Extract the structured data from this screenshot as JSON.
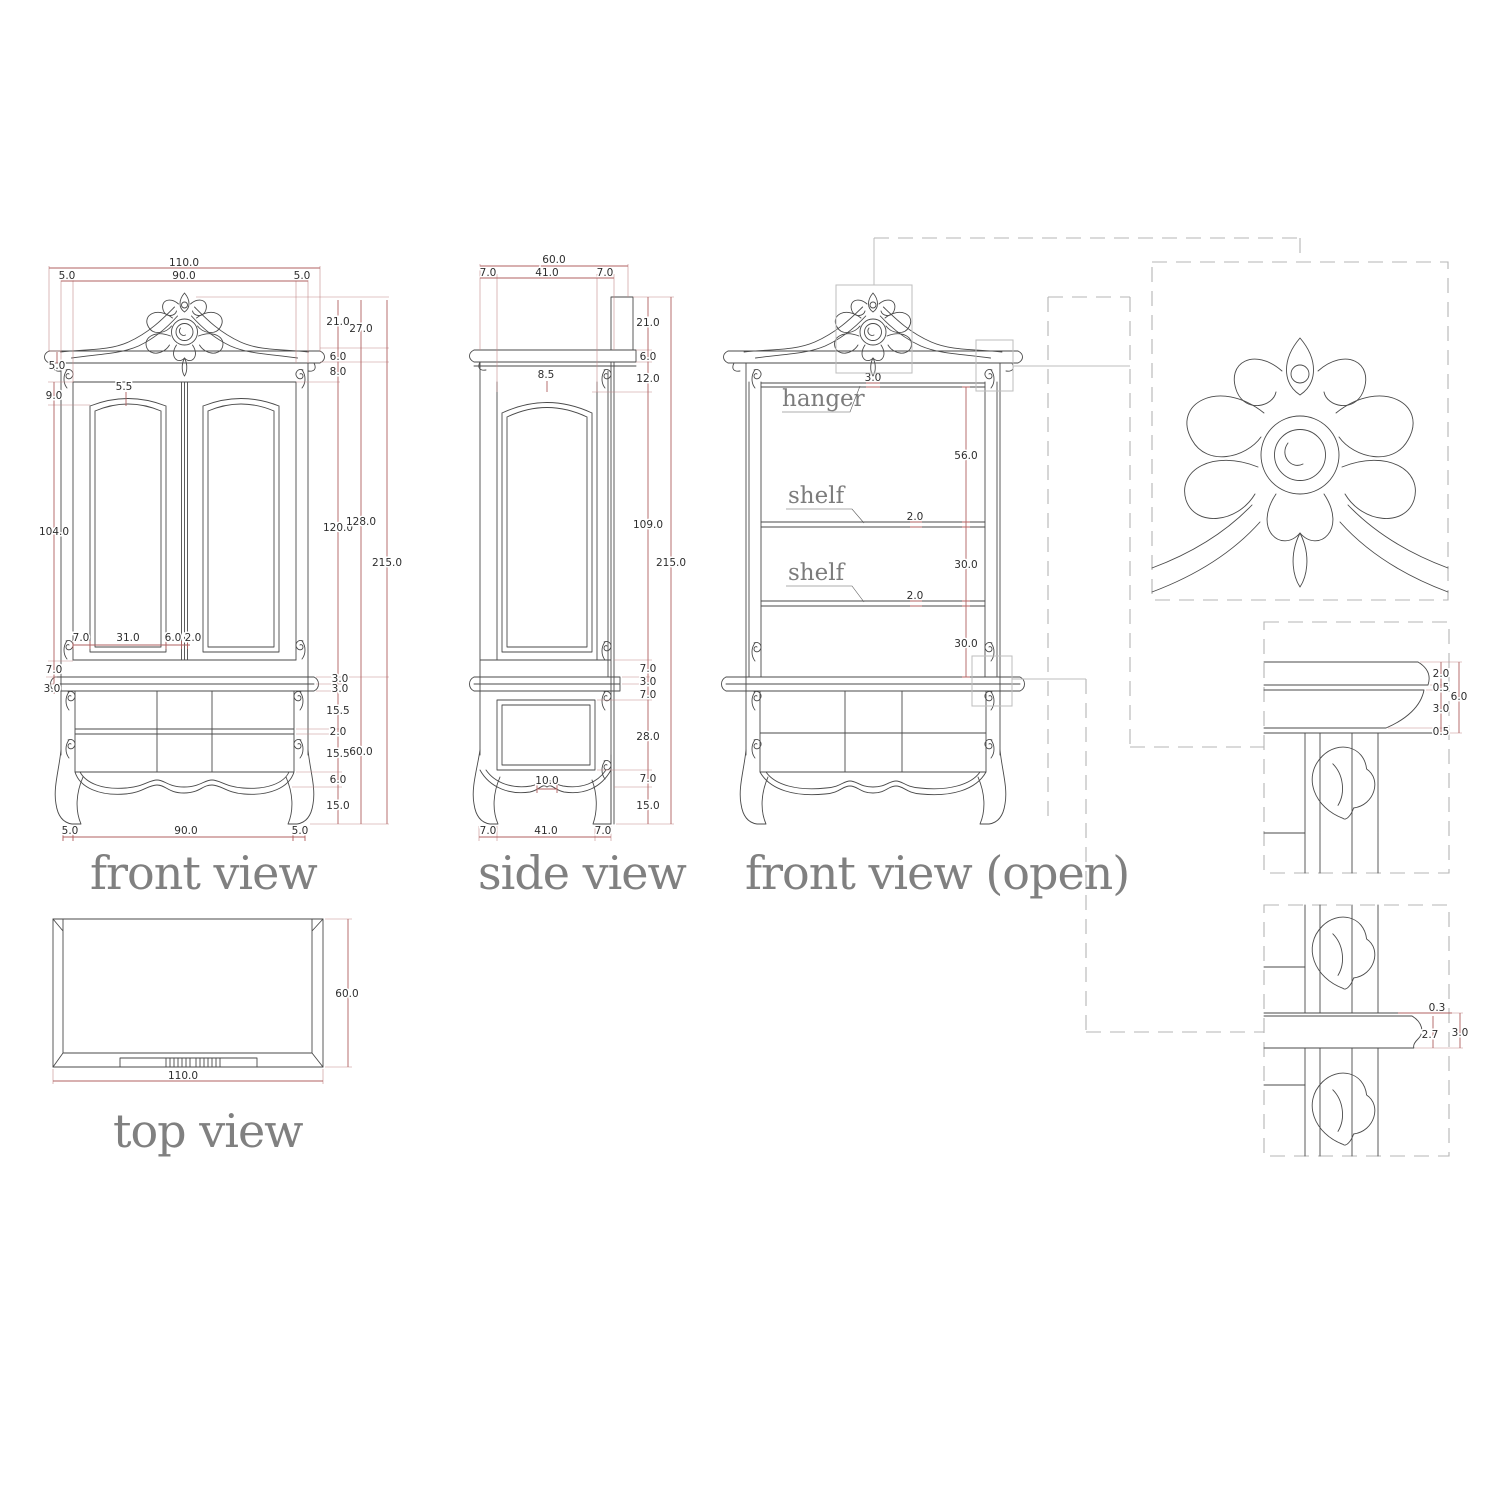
{
  "colors": {
    "drawing_line": "#4a4a4a",
    "dimension_line": "#b06060",
    "dimension_text": "#2e2e2e",
    "label_text": "#808080",
    "callout_box": "#bdbdbd",
    "dashed_connector": "#b5b5b5"
  },
  "front_view": {
    "label": "front view",
    "dims": {
      "overall_width": "110.0",
      "left_overhang": "5.0",
      "carcass_width": "90.0",
      "right_overhang": "5.0",
      "crest_height": "21.0",
      "crest_total": "27.0",
      "cornice_height": "6.0",
      "frieze_height": "8.0",
      "cornice_side": "5.0",
      "arch_drop": "9.0",
      "arch_rise": "5.5",
      "door_height": "104.0",
      "upper_body": "120.0",
      "upper_total": "128.0",
      "total_height": "215.0",
      "door_stile": "7.0",
      "door_panel": "31.0",
      "door_inner_stile": "6.0",
      "door_gap": "2.0",
      "door_bottom_gap": "7.0",
      "waist_side": "3.0",
      "waist_top": "3.0",
      "waist_bottom": "3.0",
      "drawer_top": "15.5",
      "drawer_divider": "2.0",
      "drawer_bottom": "15.5",
      "apron_height": "6.0",
      "leg_height": "15.0",
      "lower_height": "60.0",
      "foot_left": "5.0",
      "base_width": "90.0",
      "foot_right": "5.0"
    }
  },
  "side_view": {
    "label": "side view",
    "dims": {
      "overall_depth": "60.0",
      "front_frame": "7.0",
      "panel_depth": "41.0",
      "back_frame": "7.0",
      "crest_height": "21.0",
      "cornice_height": "6.0",
      "arch_top": "12.0",
      "arch_rise": "8.5",
      "panel_height": "109.0",
      "total_height": "215.0",
      "door_bottom_gap": "7.0",
      "waist": "3.0",
      "lower_top": "7.0",
      "lower_panel": "28.0",
      "apron_height": "7.0",
      "leg_height": "15.0",
      "apron_center": "10.0",
      "base_front": "7.0",
      "base_panel": "41.0",
      "base_back": "7.0"
    }
  },
  "open_view": {
    "label": "front view (open)",
    "annotations": {
      "hanger": "hanger",
      "shelf_upper": "shelf",
      "shelf_lower": "shelf"
    },
    "dims": {
      "top_rail": "3.0",
      "hanger_space": "56.0",
      "shelf_upper_thickness": "2.0",
      "space_upper": "30.0",
      "shelf_lower_thickness": "2.0",
      "space_lower": "30.0"
    }
  },
  "top_view": {
    "label": "top view",
    "dims": {
      "depth": "60.0",
      "width": "110.0"
    }
  },
  "cornice_detail": {
    "dims": {
      "fascia": "2.0",
      "upper_lip": "0.5",
      "cove": "3.0",
      "lower_lip": "0.5",
      "total": "6.0"
    }
  },
  "shelf_detail": {
    "dims": {
      "front_edge": "0.3",
      "body": "2.7",
      "total": "3.0"
    }
  }
}
